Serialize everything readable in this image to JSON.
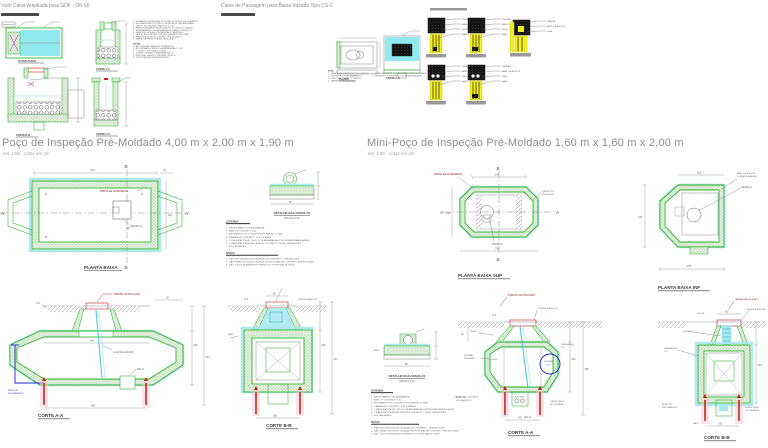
{
  "titles": {
    "tl": "PV com Caixa Ampliada para GDF - DN 60",
    "tm": "Caixa de Passagem para Bacia Vazada Tipo CS-2",
    "left": "Poço de Inspeção Pré-Moldado 4,00 m x 2,00 m x 1,90 m",
    "left_scale": "esc 1:50 - cotas em cm",
    "right": "Mini-Poço de Inspeção Pré-Moldado 1,60 m x 1,60 m x 2,00 m",
    "right_scale": "esc 1:50 - cotas em cm"
  },
  "captions": {
    "planta_baixa": "PLANTA BAIXA",
    "planta_baixa_sup": "PLANTA BAIXA SUP",
    "planta_baixa_inf": "PLANTA BAIXA INF",
    "corte_aa": "CORTE A-A",
    "corte_bb": "CORTE B-B",
    "corte_cc": "CORTE C-C",
    "planta": "PLANTA",
    "detalhe_argolas": "DETALHE DAS ARGOLAS",
    "escala_120": "ESCALA 1:20"
  },
  "axis": {
    "a": "A",
    "b": "B"
  },
  "ann": {
    "tampao": "TAMPÃO ARTICULADO",
    "parte_alvenarias": "PARTE DE ALVENARIAS",
    "nivel1": "NÍVEL DE",
    "nivel2": "ESCOAMENTO",
    "guia": "GUIA DE ACESSO",
    "degrau": "DEGRAU",
    "degrau_ferro1": "DEGRAU",
    "degrau_ferro2": "DE FERRO",
    "ralo": "RALO",
    "na": "N.A.",
    "alca": "ALÇA",
    "junta_ajuste": "JUNTA DE AJUSTE",
    "anel_ajuste1": "ANEL DE AJUSTE",
    "anel_ajuste2": "COM ARGAMASSA",
    "junta_tipo1": "JUNTA TIPO",
    "junta_tipo2": "DE AJUSTE",
    "junta_cinta1": "JUNTA CINTA",
    "junta_cinta2": "DE VEDAÇÃO",
    "drenagem1": "DRENAGEM",
    "drenagem2": "TIP.",
    "anel": "ANEL",
    "nicho": "NICHO DE CONCRETO",
    "angle": "45°"
  },
  "dims": {
    "d400": "400",
    "d460": "460",
    "d190": "190",
    "d237": "237",
    "d20": "20",
    "d200": "200",
    "d60": "60",
    "d247": "247",
    "d260": "260",
    "d160": "160",
    "d218": "218",
    "d215": "215",
    "d226": "226",
    "d250": "250",
    "d50": "50",
    "d80": "80"
  },
  "legend": {
    "header": "LEGENDA",
    "lines": [
      "1 - REVESTIMENTO DE ARGAMASSA",
      "2 - ANEL DE CONCRETO S.A.",
      "3 - ENCHIMENTO DE CONCRETO FCK MÍNIMO 15 MPA",
      "4 - CAMADA DE CONCRETO SOB OS ANÉIS",
      "5 - 1 FIADA MACIÇA DE TIJOLOS DE ARGAMASSA COM PEDRAS APARELHADAS",
      "6 - 1 FIADA MACIÇA RECALÇADA DE CONCRETO COM ALTURA BRUTA 9",
      "7 - PISO ATERRADO"
    ],
    "notas": "NOTAS",
    "notes": [
      "1 - NÃO USE IN-MOLDE DE VEDAÇÃO DE CONCRETO - PRECAUÇÕES",
      "2 - NÃO SERÃO MOLDES E VEDAÇÃO ESTRUTURAL DE CONCRETO PRÉ-MOLDADO",
      "3 - NÃO TODOS MONTAGEM E DRENOS DO PORTE MAIOR LESTE"
    ]
  },
  "notes_tl": {
    "lines": [
      "1 - ESCAVAÇÃO EM MATERIAL DE 1A CATEGORIA COM ESCORAMENTO",
      "2 - REGULARIZAÇÃO DO FUNDO COM PEDRA DE MÃO ARRUMADA",
      "3 - LASTRO DE CONCRETO MAGRO E = 5 CM",
      "4 - PAREDES EM ANÉIS PRÉ-MOLDADOS DE CONCRETO VIBRADO",
      "5 - REJUNTAMENTO COM ARGAMASSA DE CIMENTO E AREIA 1:3",
      "6 - REATERRO LATERAL COM MATERIAL COMPACTADO",
      "7 - LAJE DE REDUÇÃO EM CONCRETO ARMADO FCK 15 MPA",
      "8 - ANÉIS DE AJUSTE EM CONCRETO PRÉ-MOLDADO",
      "9 - TAMPÃO DE FERRO FUNDIDO ARTICULADO"
    ],
    "notas": "NOTAS",
    "notes": [
      "1 - AS COTAS SÃO DADAS EM CENTÍMETROS",
      "2 - RECOBRIMENTO MÍNIMO DAS ARMADURAS 2,5 CM",
      "3 - CONCRETO FCK MÍNIMO 15 MPA",
      "4 - JUNTAS TOMADAS COM ARGAMASSA 1:3",
      "5 - EXECUTAR DRENOS CONFORME PROJETO",
      "6 - VER DETALHES DE ASSENTAMENTO"
    ]
  },
  "notes_tm": {
    "header": "NOTA:",
    "left": [
      "1 - CAIXA EM ALVENARIA DE TIJOLO MACIÇO",
      "2 - REVESTIDA COM ARGAMASSA 1:3",
      "3 - FUNDO EM CONCRETO SIMPLES",
      "4 - TAMPA EM GRELHA DE AÇO"
    ],
    "right": [
      "1 - A GRELHA DEVERÁ SER ASSENTADA SOBRE A CINTA DE CONCRETO ARMADO",
      "2 - DIMENSÕES CONFORME O TIPO DA BACIA VAZADA"
    ]
  },
  "details_tr": {
    "labels": [
      "TAMPÃO",
      "ANEL DE AJUSTE",
      "LAJE",
      "BASE"
    ]
  }
}
